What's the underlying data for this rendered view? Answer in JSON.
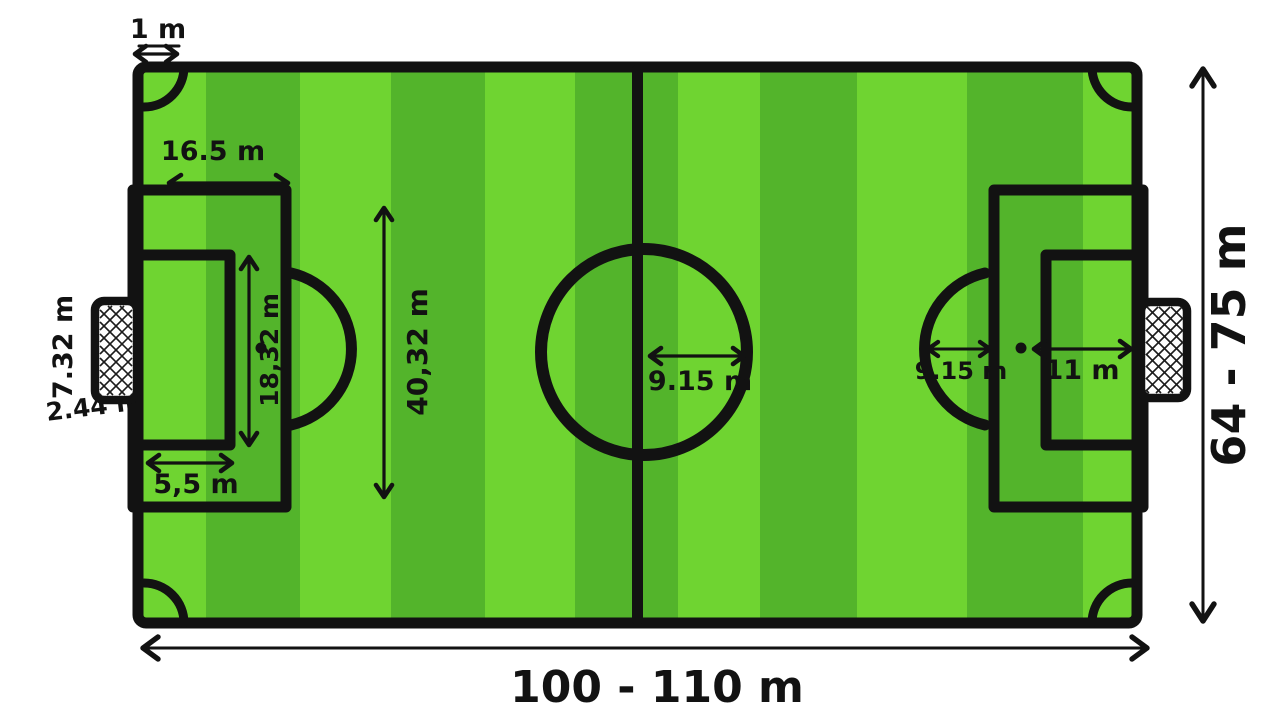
{
  "colors": {
    "background": "#ffffff",
    "stripe_light": "#6fd431",
    "stripe_dark": "#53b42b",
    "line_black": "#121212"
  },
  "dimensions": {
    "corner_arc": "1 m",
    "penalty_area_depth": "16.5 m",
    "goal_width": "7.32 m",
    "goal_height": "2.44 m",
    "goal_area_depth": "5,5 m",
    "goal_area_width": "18,32 m",
    "penalty_area_width": "40,32 m",
    "centre_circle_radius": "9.15 m",
    "penalty_arc_radius": "9.15 m",
    "penalty_mark_distance": "11 m",
    "pitch_width": "64 - 75 m",
    "pitch_length": "100 - 110 m"
  }
}
